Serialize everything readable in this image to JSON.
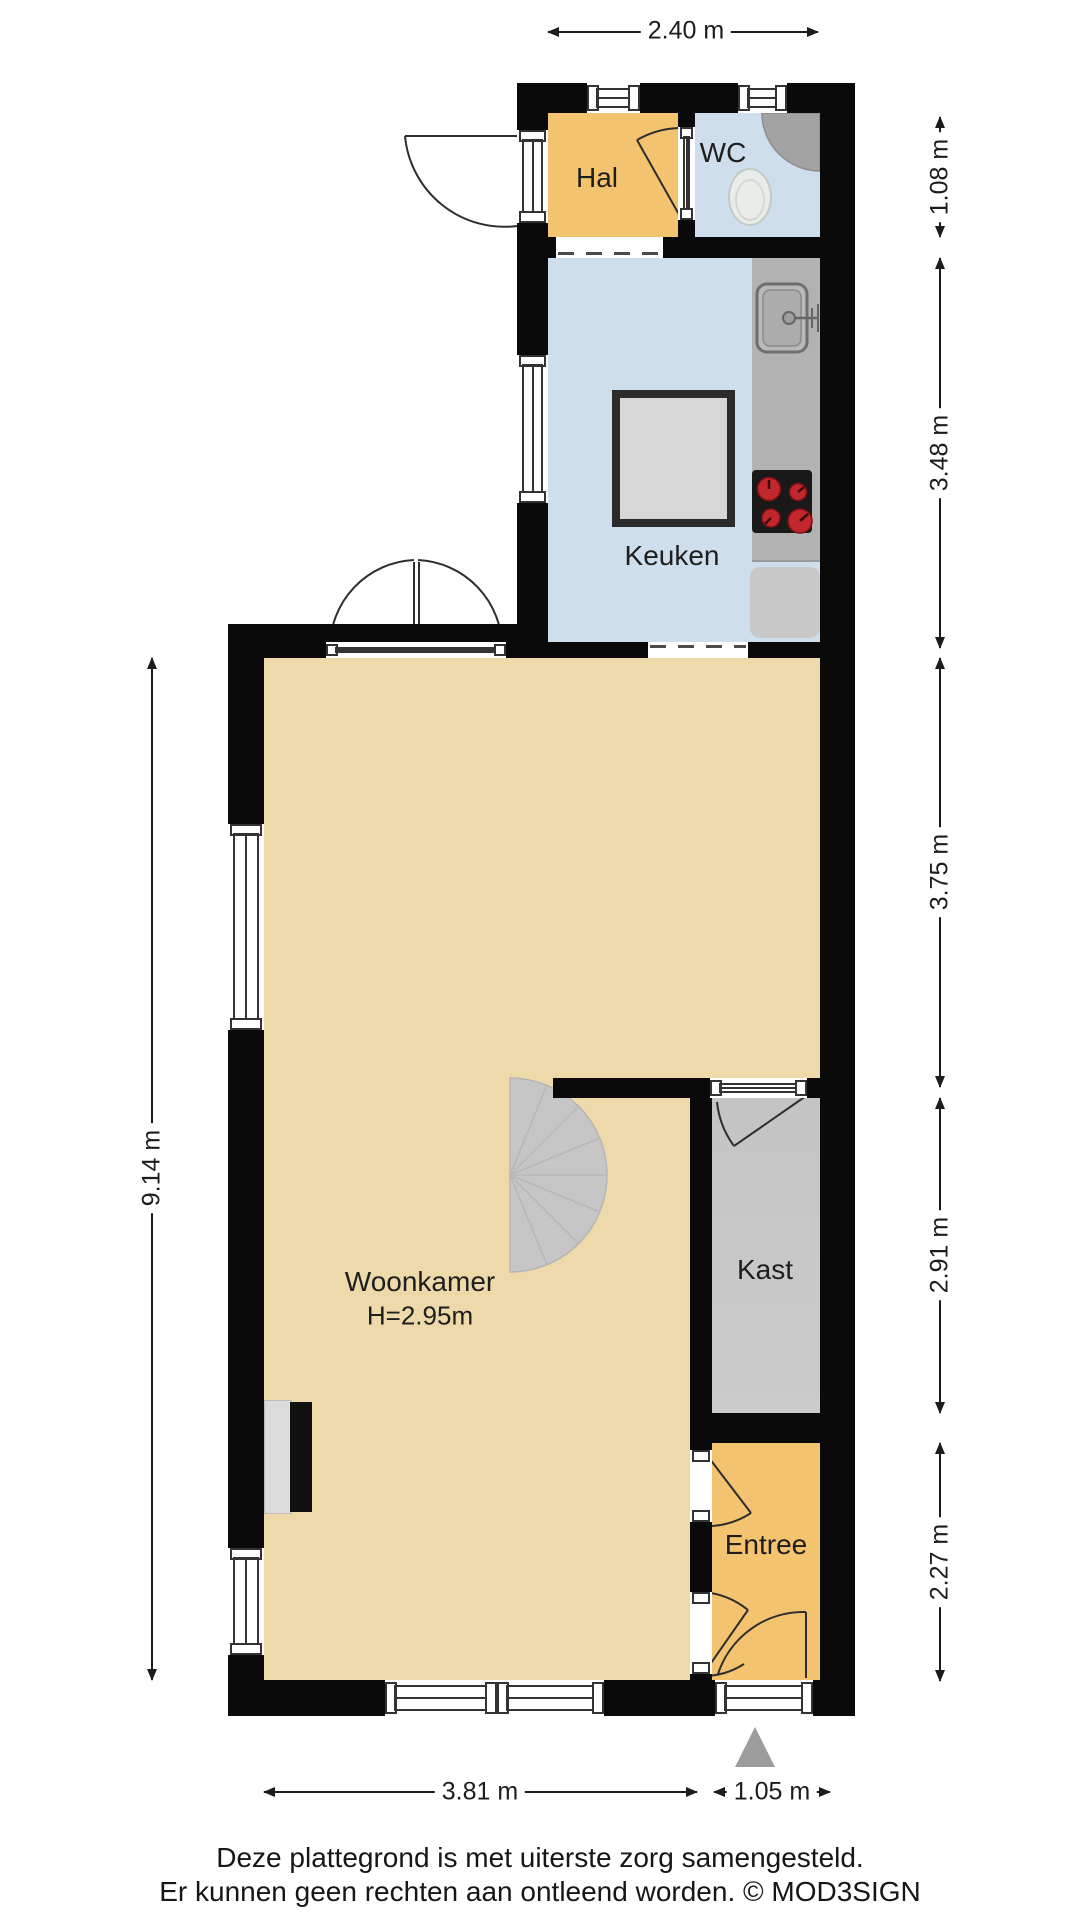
{
  "rooms": {
    "hal": {
      "label": "Hal"
    },
    "wc": {
      "label": "WC"
    },
    "keuken": {
      "label": "Keuken"
    },
    "woonkamer": {
      "label": "Woonkamer",
      "height": "H=2.95m"
    },
    "kast": {
      "label": "Kast"
    },
    "entree": {
      "label": "Entree"
    }
  },
  "dimensions": {
    "top": "2.40 m",
    "left": "9.14 m",
    "right": [
      "1.08 m",
      "3.48 m",
      "3.75 m",
      "2.91 m",
      "2.27 m"
    ],
    "bottom_left": "3.81 m",
    "bottom_right": "1.05 m"
  },
  "footer": {
    "line1": "Deze plattegrond is met uiterste zorg samengesteld.",
    "line2": "Er kunnen geen rechten aan ontleend worden. © MOD3SIGN"
  },
  "colors": {
    "wall": "#0a0a0a",
    "hal_entree_floor": "#f3c36f",
    "wc_keuken_floor": "#cfdeec",
    "woonkamer_floor": "#eed9aa",
    "kast_floor": "#c7c7c7",
    "counter": "#b2b2b2",
    "table": "#d7d7d7",
    "burner_red": "#c1272d",
    "stairs": "#c6c6c6",
    "north_arrow": "#9c9c9c",
    "dimension_text": "#1c1c1c"
  }
}
